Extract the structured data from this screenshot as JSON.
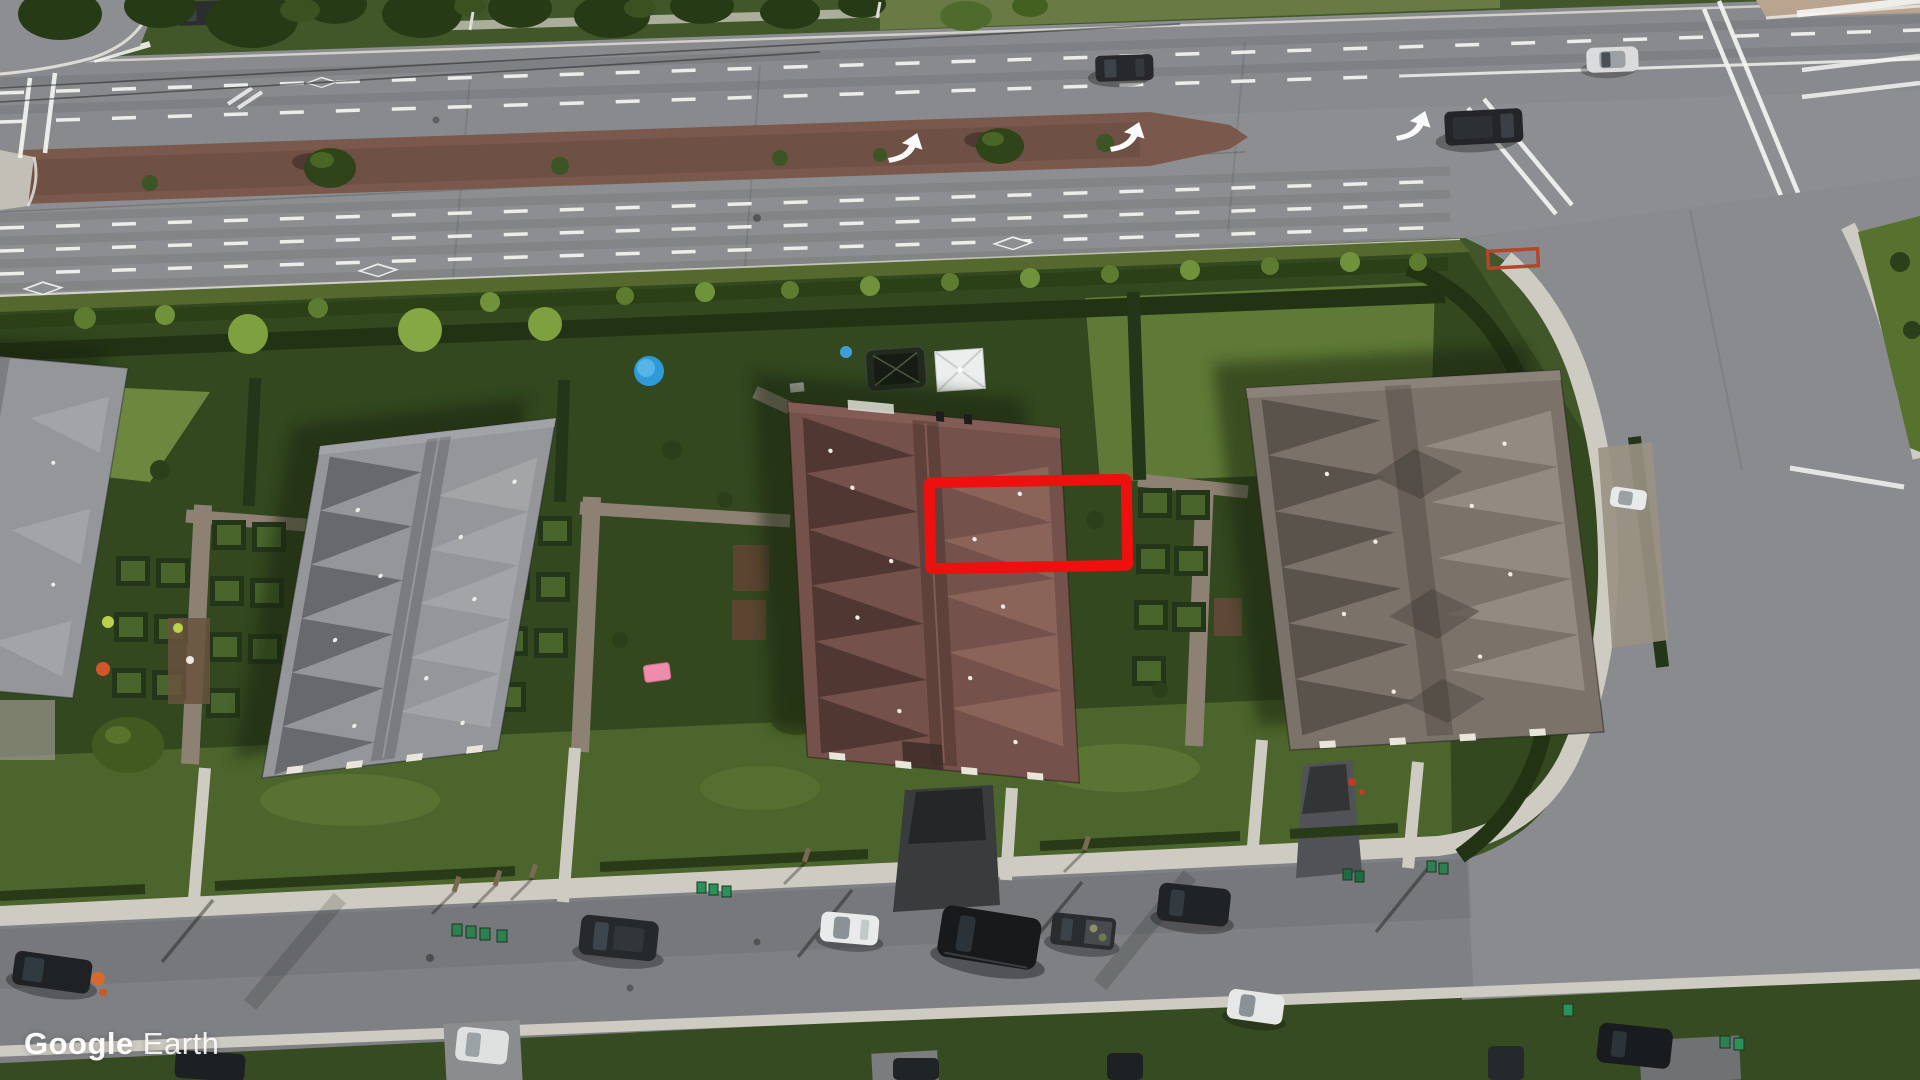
{
  "app": {
    "name": "Google Earth"
  },
  "watermark": {
    "brand": "Google",
    "product": "Earth"
  },
  "annotation": {
    "type": "rectangle",
    "color": "#ee0f0f",
    "stroke_width": 11,
    "x": 930,
    "y": 481,
    "width": 197,
    "height": 86,
    "rotation_deg": -1,
    "target": "roof-section-and-rear-patio-of-middle-townhouse"
  },
  "palette": {
    "annotation": "#ee0f0f",
    "road": "#8d8e91",
    "road-res": "#7f8084",
    "sidewalk": "#cecbc2",
    "median-brick": "#7b584c",
    "grass": "#41572a",
    "grass-dark": "#33481f",
    "grass-mid": "#4c652c",
    "grass-bright": "#65803a",
    "hedge": "#24361a",
    "tree-dark": "#273a16",
    "roof-left": "#94969a",
    "roof-middle": "#74514a",
    "roof-right": "#7b726a",
    "watermark-text": "#ffffff"
  },
  "scene": {
    "type": "oblique-aerial-satellite-photo",
    "description": "Suburban block with three large townhouse buildings between a multi-lane arterial road (top) and a residential street (bottom); red rectangle highlights part of the middle building's roof and rear patio",
    "objects": [
      "arterial-road",
      "brick-median-with-trees",
      "hov-diamond-markings",
      "left-turn-arrows",
      "crosswalks",
      "tree-row",
      "hedge-rows",
      "townhouse-building-left",
      "townhouse-building-middle",
      "townhouse-building-right",
      "backyard-garden-plots",
      "trampoline",
      "white-canopy-tent",
      "blue-kiddie-pool",
      "residential-street",
      "parked-cars",
      "green-bins",
      "side-street",
      "underground-garage-ramps",
      "annotation-rectangle",
      "google-earth-watermark"
    ]
  }
}
